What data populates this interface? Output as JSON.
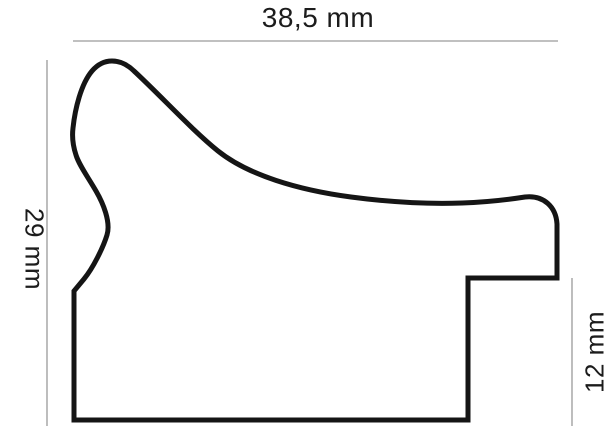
{
  "diagram": {
    "kind": "frame-moulding-profile-cross-section",
    "background_color": "#ffffff",
    "outline_color": "#151515",
    "dimension_line_color": "#9a9a9a",
    "label_color": "#1c1c1c",
    "profile_path_d": "M 74 420 L 74 291 L 84 279 C 93 268 103 248 107 235 C 111 222 103 203 96 191 C 88 177 79 165 76 155 C 73 146 72 136 73 128 C 75 109 81 84 92 71 C 98 64 105 61 112 61 C 120 61 128 65 134 71 C 162 97 192 130 218 151 C 248 175 298 190 351 197 C 396 203 433 204 462 203 C 492 202 512 199 525 197 C 544 195 556 207 557 224 L 557 278 L 468 278 L 468 420 Z",
    "dimensions": {
      "width": {
        "label": "38,5 mm",
        "value_mm": 38.5,
        "edge": "top"
      },
      "height": {
        "label": "29 mm",
        "value_mm": 29,
        "edge": "left"
      },
      "rabbet_height": {
        "label": "12 mm",
        "value_mm": 12,
        "edge": "right"
      }
    }
  }
}
